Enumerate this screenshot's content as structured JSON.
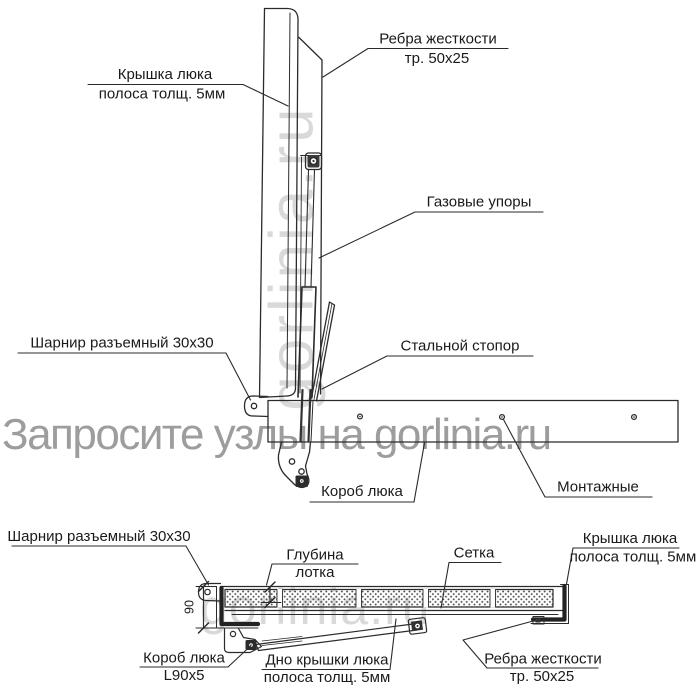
{
  "watermarks": {
    "main": "Запросите узлы на gorlinia.ru",
    "vertical_panel": "gorlinia.ru",
    "bottom_view": "gorlinia.ru"
  },
  "colors": {
    "line": "#2b2b2b",
    "label_text": "#1a1a1a",
    "watermark_dark": "#8d8d8d",
    "watermark_light": "#c9c9c9"
  },
  "top_view": {
    "labels": {
      "cover1": "Крышка люка",
      "cover2": "полоса толщ. 5мм",
      "ribs1": "Ребра жесткости",
      "ribs2": "тр. 50х25",
      "gas": "Газовые упоры",
      "hinge": "Шарнир разъемный 30х30",
      "stopper": "Стальной стопор",
      "box": "Короб люка",
      "mounting": "Монтажные"
    }
  },
  "bottom_view": {
    "labels": {
      "hinge": "Шарнир разъемный 30х30",
      "dim90": "90",
      "depth1": "Глубина",
      "depth2": "лотка",
      "mesh": "Сетка",
      "cover1": "Крышка люка",
      "cover2": "полоса толщ. 5мм",
      "box1": "Короб люка",
      "box2": "L90x5",
      "bottom1": "Дно крышки люка",
      "bottom2": "полоса толщ. 5мм",
      "ribs1": "Ребра жесткости",
      "ribs2": "тр. 50х25"
    }
  }
}
